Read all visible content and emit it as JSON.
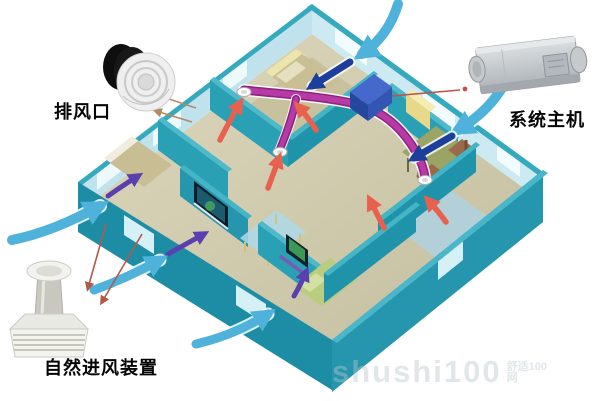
{
  "diagram": {
    "subject": "fresh-air-ventilation-system-cutaway-house",
    "labels": {
      "exhaust_outlet": "排风口",
      "system_unit": "系统主机",
      "air_inlet": "自然进风装置"
    },
    "watermark": {
      "text": "shushi100",
      "suffix": "舒适100网"
    },
    "airflow": {
      "fresh_air_outdoor_color": "#4fb2da",
      "fresh_air_indoor_color": "#1d3f9c",
      "supply_air_color": "#5a3fae",
      "exhaust_air_color": "#e8604e",
      "duct_color": "#a8309a"
    },
    "palette": {
      "background": "#ffffff",
      "outer_wall": "#1d8da6",
      "inner_wall_nw": "#bfe2ec",
      "inner_wall_ne": "#cdeaf2",
      "wall_top": "#35a9bd",
      "interior_wall": "#2aa0b4",
      "floor": "#cfc9a9",
      "bath_floor": "#abd3e8",
      "unit_gray": "#c6cacd"
    }
  }
}
